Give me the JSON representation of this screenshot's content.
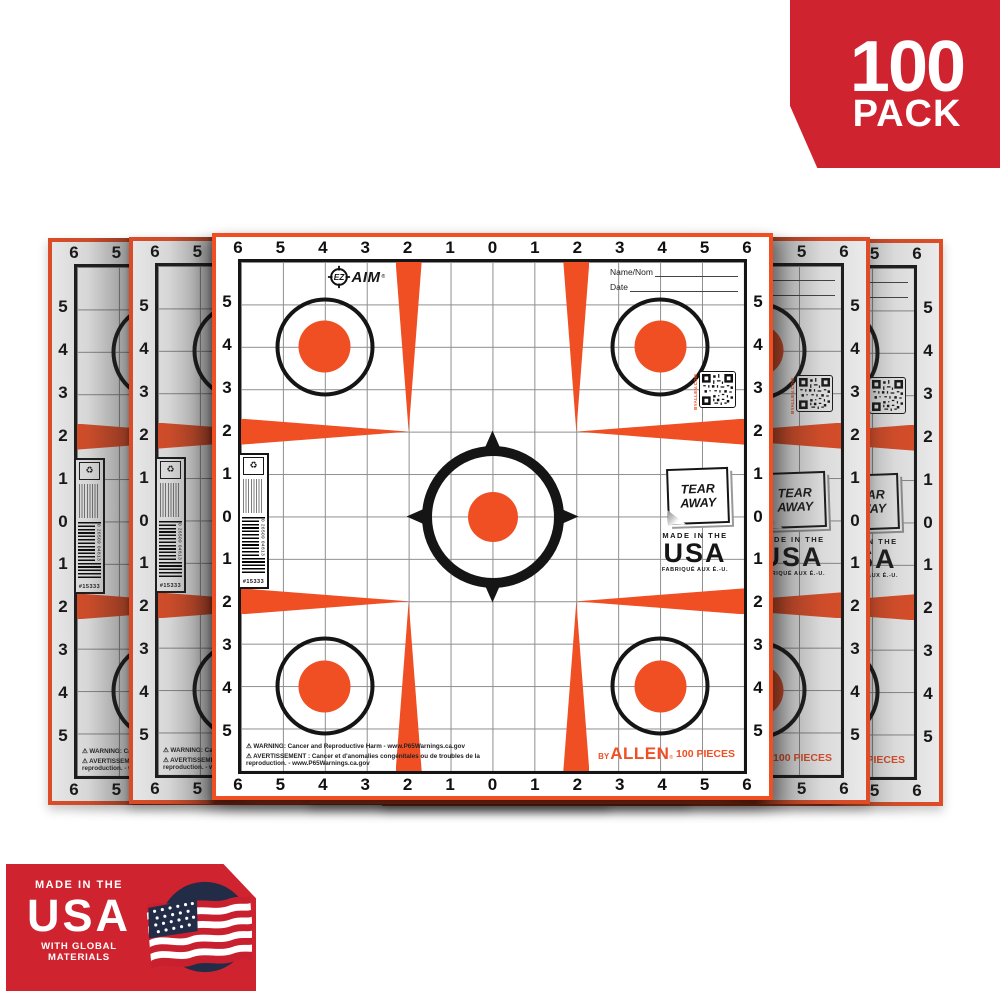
{
  "colors": {
    "orange": "#f04e23",
    "badge-red": "#cf2430",
    "ink": "#151515",
    "grid-line": "#8f8f8f",
    "navy": "#232c47"
  },
  "pack_badge": {
    "count": "100",
    "label": "PACK"
  },
  "usa_badge": {
    "line1": "MADE IN THE",
    "line2": "USA",
    "line3": "WITH GLOBAL",
    "line4": "MATERIALS"
  },
  "target": {
    "brand": {
      "ez": "EZ",
      "aim": "AIM",
      "reg": "®"
    },
    "name_label": "Name/Nom",
    "date_label": "Date",
    "axis_labels": [
      "6",
      "5",
      "4",
      "3",
      "2",
      "1",
      "0",
      "1",
      "2",
      "3",
      "4",
      "5",
      "6"
    ],
    "qr_caption": "BYALLEN.COM",
    "tear_away": {
      "line1": "TEAR",
      "line2": "AWAY"
    },
    "made_in": {
      "line1": "MADE IN THE",
      "line2": "USA",
      "line3": "FABRIQUÉ AUX É.-U."
    },
    "brand_by": "BY",
    "allen": "ALLEN",
    "pieces": "100 PIECES",
    "warning_en": "⚠ WARNING: Cancer and Reproductive Harm - www.P65Warnings.ca.gov",
    "warning_fr": "⚠ AVERTISSEMENT : Cancer et d'anomalies congénitales ou de troubles de la reproduction. - www.P65Warnings.ca.gov",
    "barcode_number": "0 26509 04813",
    "sku": "#15333",
    "recycle_icon": "♻"
  }
}
